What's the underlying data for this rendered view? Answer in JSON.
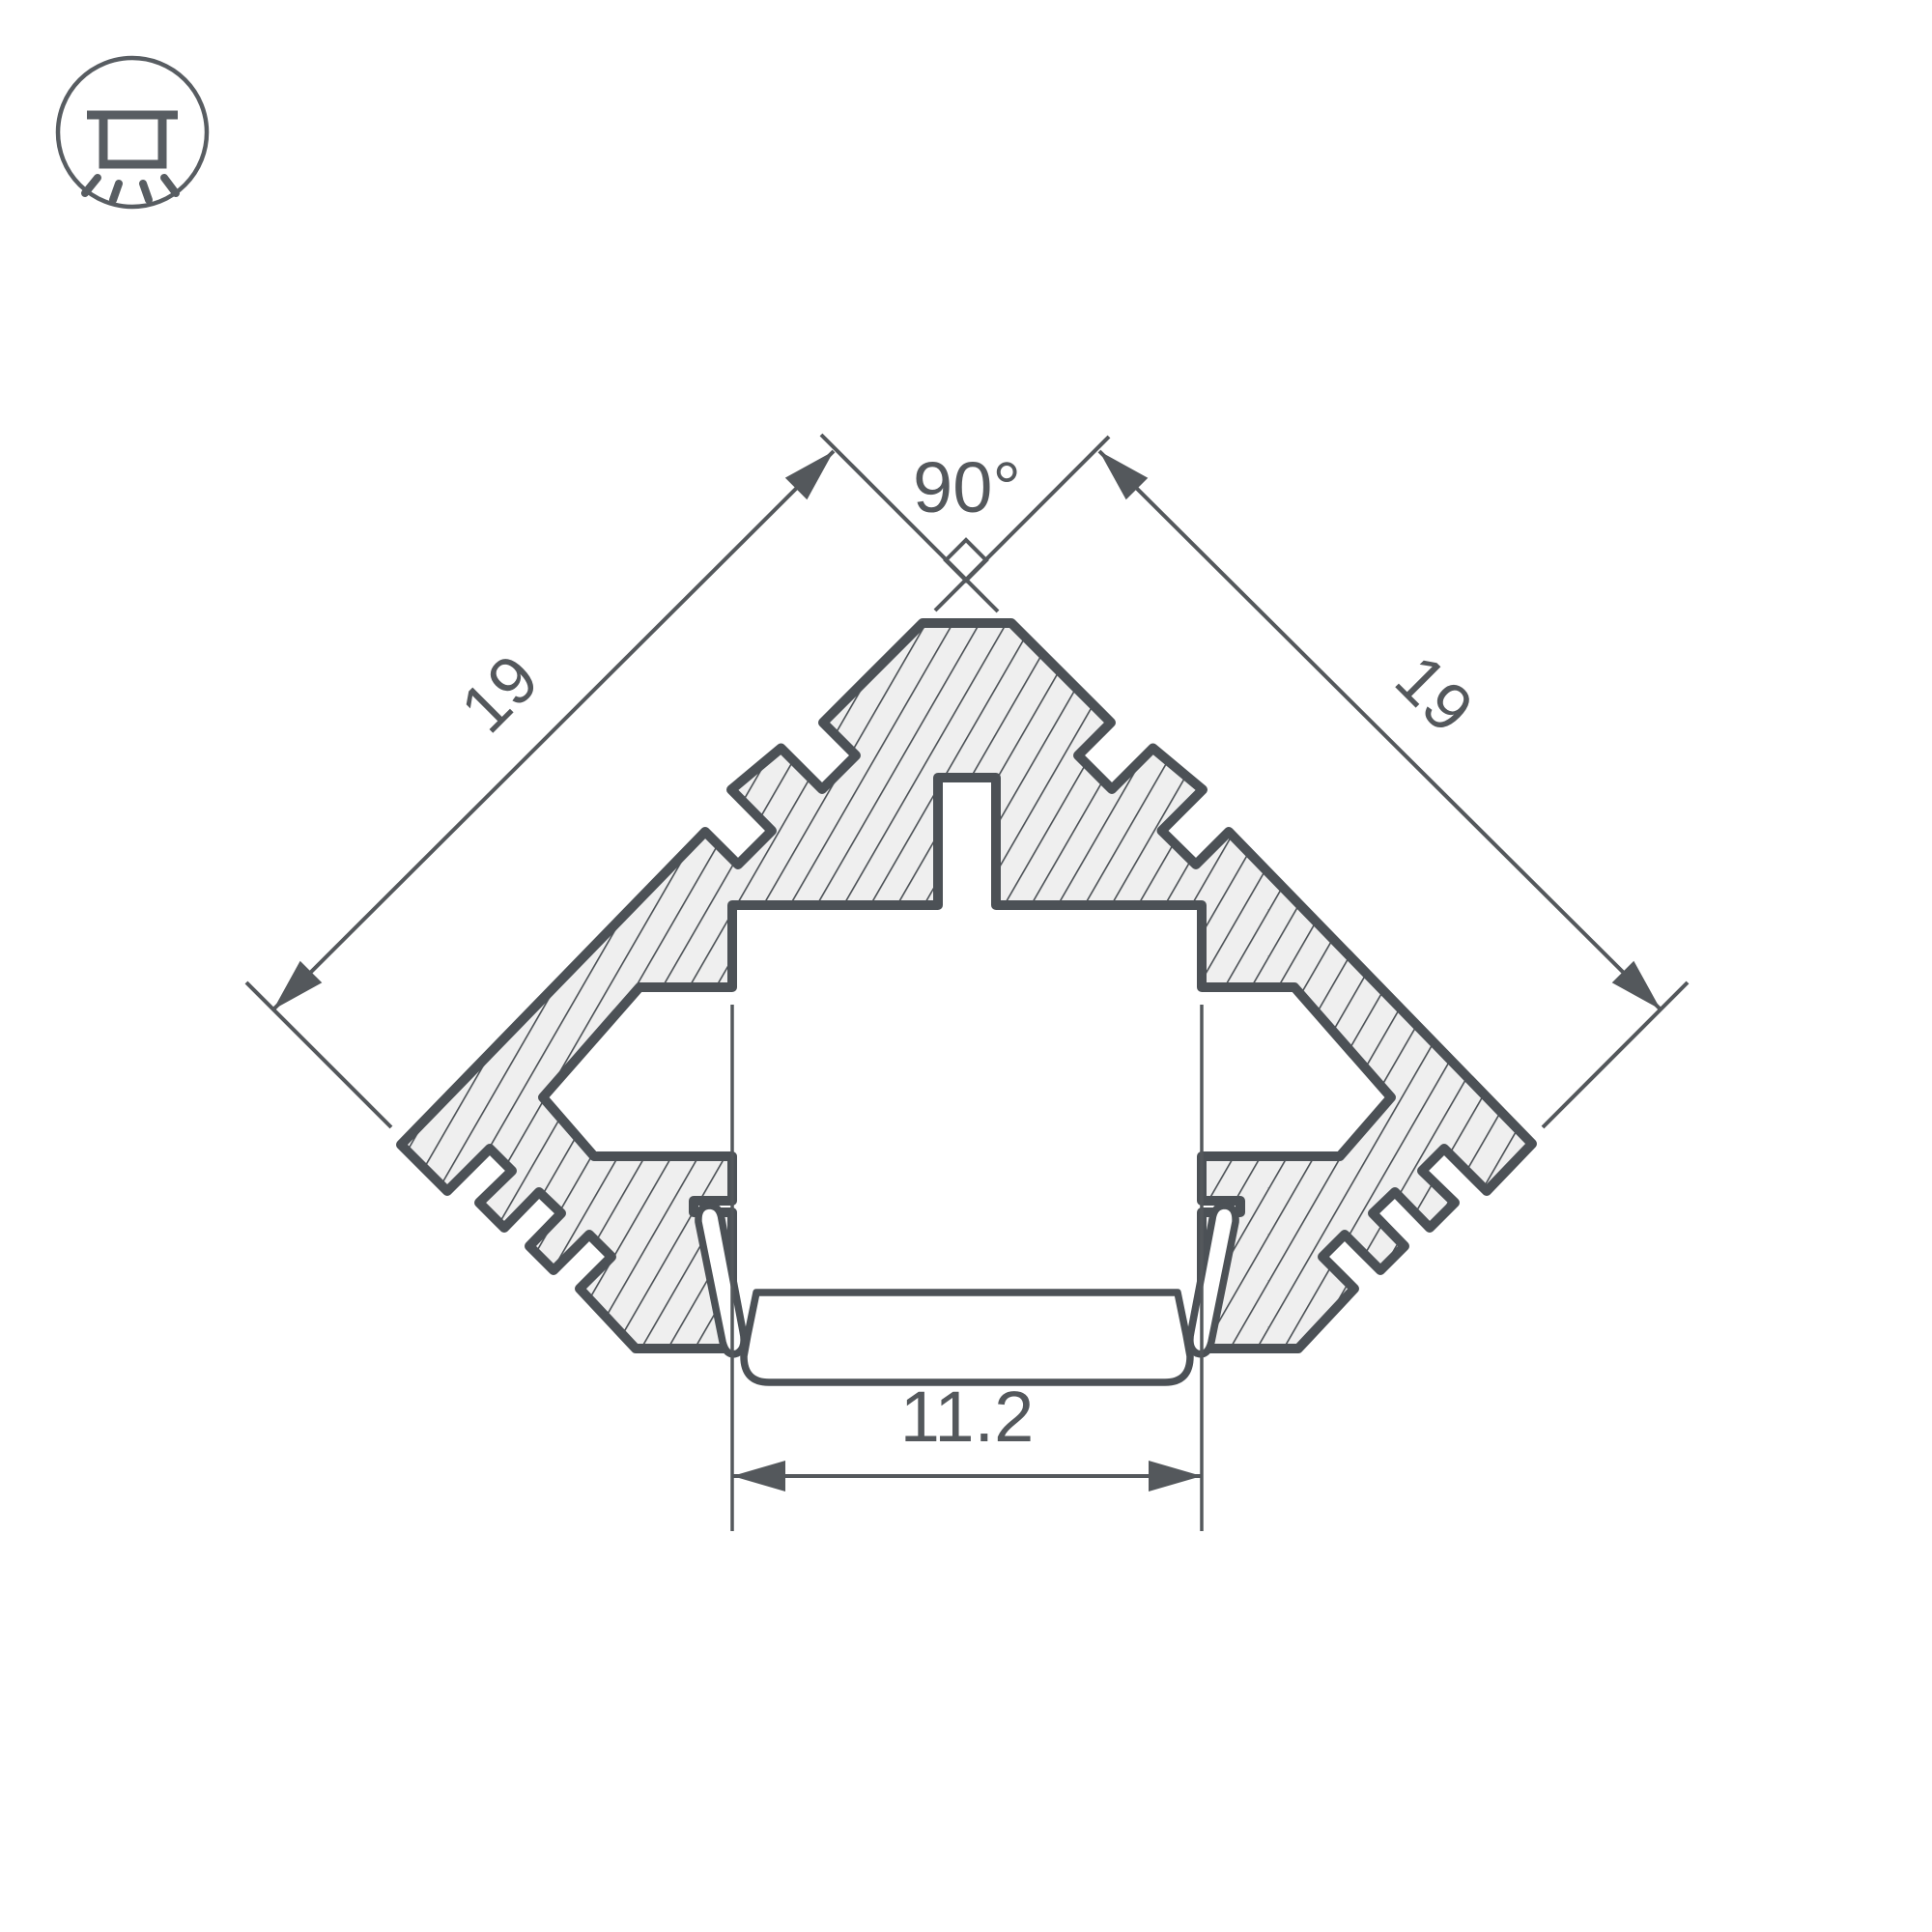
{
  "icon_badge": {
    "name": "recessed-ceiling-light",
    "shape": "circle-outline"
  },
  "drawing": {
    "type": "profile-cross-section",
    "labels": {
      "angle": "90°",
      "side_left": "19",
      "side_right": "19",
      "width_bottom": "11.2"
    },
    "colors": {
      "outline": "#4c5156",
      "hatch_fill": "#efefef",
      "hatch_line": "#4c5156",
      "dimension_line": "#54585c",
      "text": "#54585c",
      "background": "#ffffff"
    }
  }
}
